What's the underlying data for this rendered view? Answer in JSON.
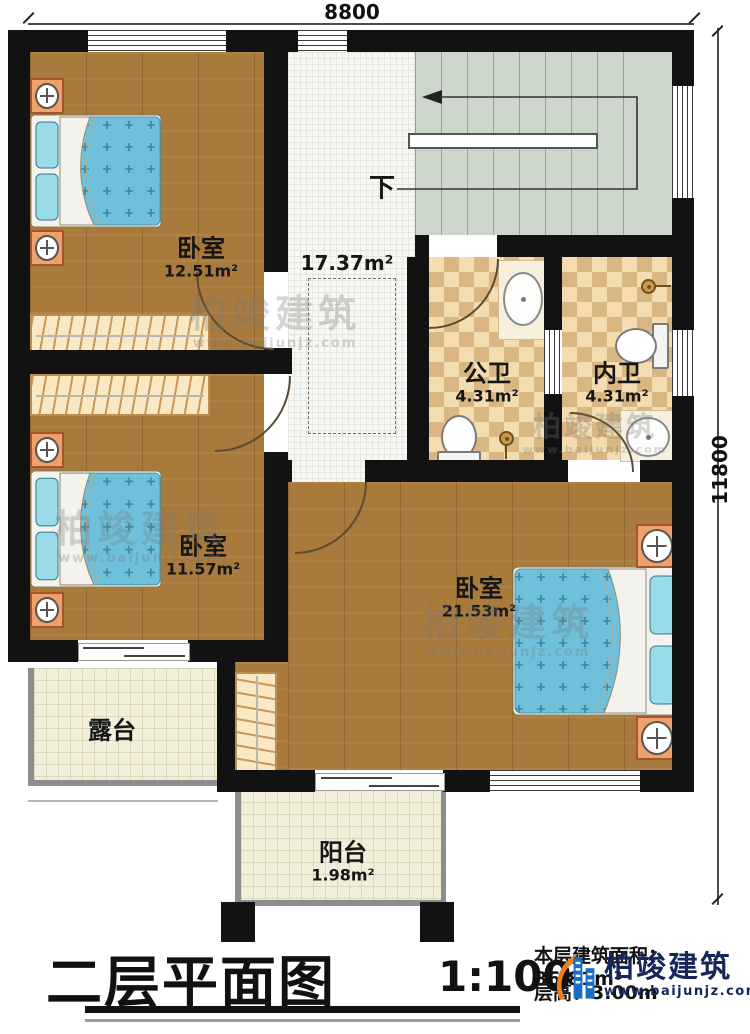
{
  "dimensions": {
    "top": "8800",
    "right": "11800"
  },
  "rooms": {
    "bedroom1": {
      "name": "卧室",
      "area": "12.51m²"
    },
    "hall": {
      "area": "17.37m²"
    },
    "stairs": {
      "direction": "下"
    },
    "bath_public": {
      "name": "公卫",
      "area": "4.31m²"
    },
    "bath_ensuite": {
      "name": "内卫",
      "area": "4.31m²"
    },
    "bedroom2": {
      "name": "卧室",
      "area": "11.57m²"
    },
    "bedroom3": {
      "name": "卧室",
      "area": "21.53m²"
    },
    "terrace": {
      "name": "露台"
    },
    "balcony": {
      "name": "阳台",
      "area": "1.98m²"
    }
  },
  "title_block": {
    "title": "二层平面图",
    "scale": "1:100",
    "area_info": "本层建筑面积：86.81m²",
    "height_info": "层高：3.00m"
  },
  "branding": {
    "company": "柏竣建筑",
    "website": "www.baijunjz.com"
  },
  "colors": {
    "wall": "#121212",
    "wood_floor": "#a87a3c",
    "stairs": "#ccd6cb",
    "tile_light": "#f3ddb0",
    "tile_dark": "#d9b682",
    "mattress": "#6fc0da",
    "logo_navy": "#15265a",
    "logo_orange": "#e8821e",
    "logo_blue": "#1a6fc4"
  }
}
